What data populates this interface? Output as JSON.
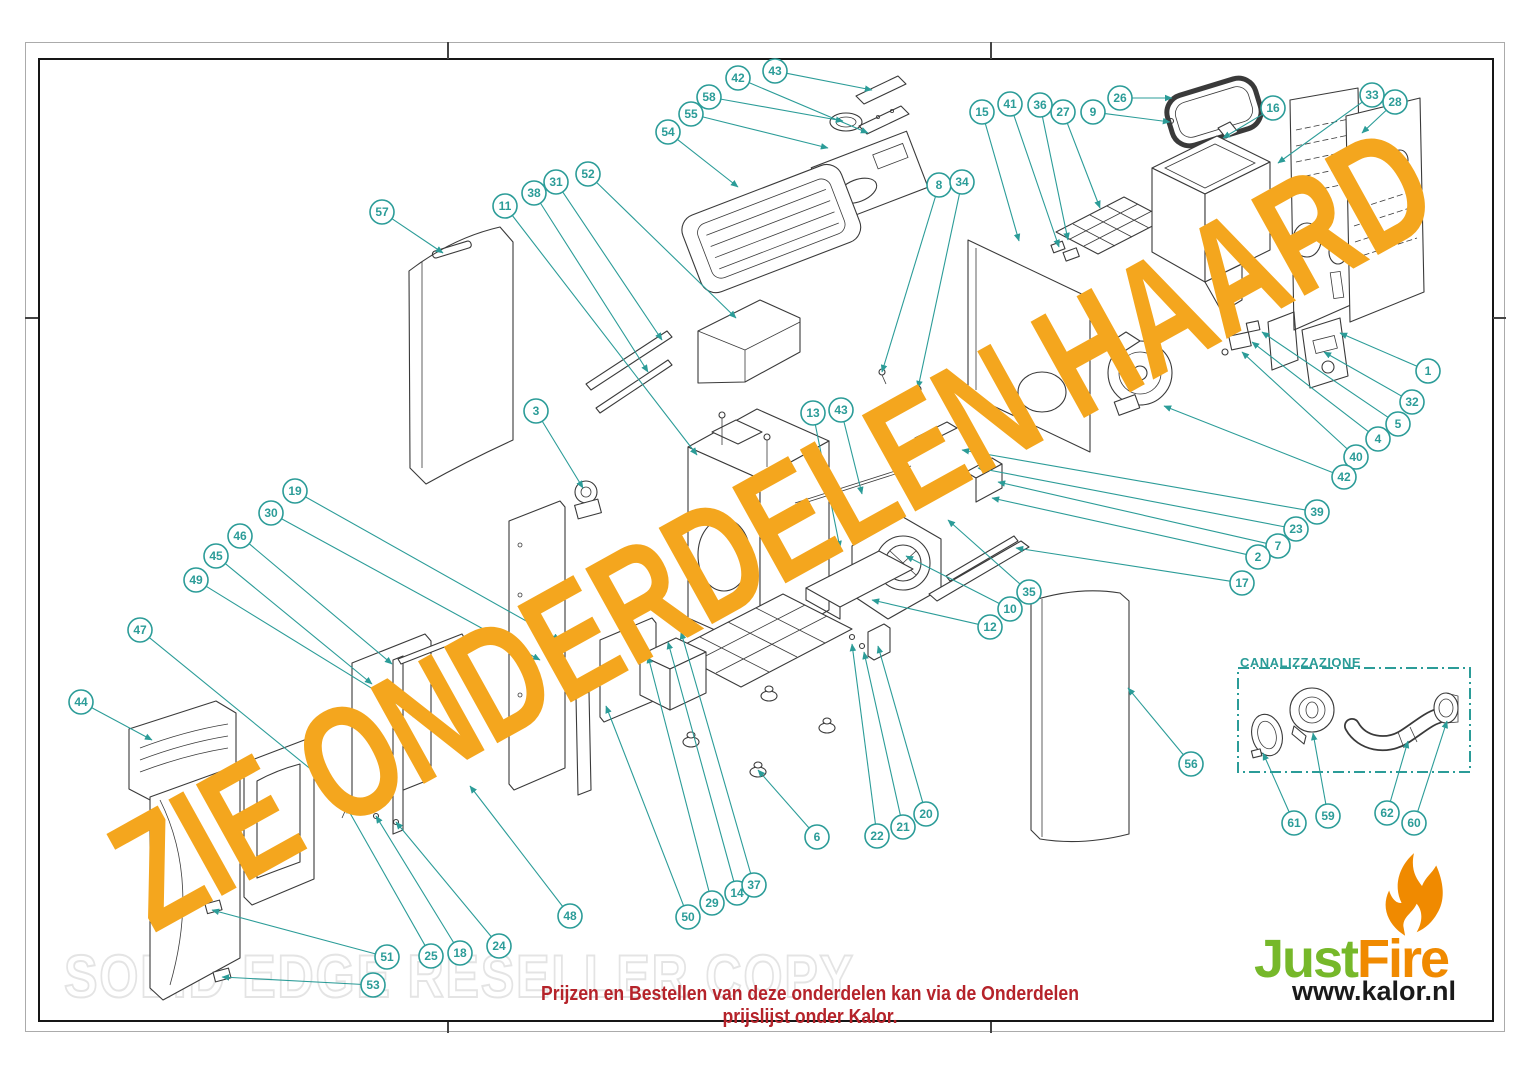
{
  "watermark": {
    "text": "ZIE ONDERDELEN HAARD",
    "color": "#F4A61E"
  },
  "copy_watermark": {
    "text": "SOLID EDGE RESELLER COPY"
  },
  "footer": {
    "order_note": "Prijzen en Bestellen van deze onderdelen kan via de Onderdelen prijslijst onder Kalor.",
    "color": "#B5232A"
  },
  "logo": {
    "brand_part1": "Just",
    "brand_part2": "Fire",
    "website": "www.kalor.nl",
    "green": "#76B82A",
    "orange": "#F08A00"
  },
  "inset_box": {
    "label": "CANALIZZAZIONE",
    "color": "#2B9C98"
  },
  "diagram": {
    "callout_color": "#2B9C98",
    "line_color": "#3a3a3a",
    "callouts": [
      {
        "n": "43",
        "x": 775,
        "y": 71,
        "tx": 872,
        "ty": 90
      },
      {
        "n": "42",
        "x": 738,
        "y": 78,
        "tx": 868,
        "ty": 133
      },
      {
        "n": "58",
        "x": 709,
        "y": 97,
        "tx": 843,
        "ty": 121
      },
      {
        "n": "55",
        "x": 691,
        "y": 114,
        "tx": 828,
        "ty": 148
      },
      {
        "n": "54",
        "x": 668,
        "y": 132,
        "tx": 738,
        "ty": 187
      },
      {
        "n": "26",
        "x": 1120,
        "y": 98,
        "tx": 1172,
        "ty": 98
      },
      {
        "n": "9",
        "x": 1093,
        "y": 112,
        "tx": 1170,
        "ty": 122
      },
      {
        "n": "27",
        "x": 1063,
        "y": 112,
        "tx": 1100,
        "ty": 208
      },
      {
        "n": "36",
        "x": 1040,
        "y": 105,
        "tx": 1068,
        "ty": 240
      },
      {
        "n": "41",
        "x": 1010,
        "y": 104,
        "tx": 1059,
        "ty": 247
      },
      {
        "n": "15",
        "x": 982,
        "y": 112,
        "tx": 1019,
        "ty": 241
      },
      {
        "n": "16",
        "x": 1273,
        "y": 108,
        "tx": 1223,
        "ty": 138
      },
      {
        "n": "33",
        "x": 1372,
        "y": 95,
        "tx": 1278,
        "ty": 163
      },
      {
        "n": "28",
        "x": 1395,
        "y": 102,
        "tx": 1362,
        "ty": 133
      },
      {
        "n": "8",
        "x": 939,
        "y": 185,
        "tx": 882,
        "ty": 372
      },
      {
        "n": "34",
        "x": 962,
        "y": 182,
        "tx": 918,
        "ty": 388
      },
      {
        "n": "57",
        "x": 382,
        "y": 212,
        "tx": 443,
        "ty": 253
      },
      {
        "n": "11",
        "x": 505,
        "y": 206,
        "tx": 697,
        "ty": 455
      },
      {
        "n": "38",
        "x": 534,
        "y": 193,
        "tx": 648,
        "ty": 372
      },
      {
        "n": "31",
        "x": 556,
        "y": 182,
        "tx": 662,
        "ty": 340
      },
      {
        "n": "52",
        "x": 588,
        "y": 174,
        "tx": 736,
        "ty": 318
      },
      {
        "n": "3",
        "x": 536,
        "y": 411,
        "tx": 583,
        "ty": 488
      },
      {
        "n": "13",
        "x": 813,
        "y": 413,
        "tx": 840,
        "ty": 548
      },
      {
        "n": "43",
        "x": 841,
        "y": 410,
        "tx": 862,
        "ty": 494
      },
      {
        "n": "1",
        "x": 1428,
        "y": 371,
        "tx": 1340,
        "ty": 333
      },
      {
        "n": "32",
        "x": 1412,
        "y": 402,
        "tx": 1324,
        "ty": 352
      },
      {
        "n": "5",
        "x": 1398,
        "y": 424,
        "tx": 1262,
        "ty": 332
      },
      {
        "n": "4",
        "x": 1378,
        "y": 439,
        "tx": 1252,
        "ty": 342
      },
      {
        "n": "40",
        "x": 1356,
        "y": 457,
        "tx": 1242,
        "ty": 352
      },
      {
        "n": "42",
        "x": 1344,
        "y": 477,
        "tx": 1164,
        "ty": 406
      },
      {
        "n": "39",
        "x": 1317,
        "y": 512,
        "tx": 962,
        "ty": 450
      },
      {
        "n": "23",
        "x": 1296,
        "y": 529,
        "tx": 978,
        "ty": 468
      },
      {
        "n": "7",
        "x": 1278,
        "y": 546,
        "tx": 998,
        "ty": 482
      },
      {
        "n": "2",
        "x": 1258,
        "y": 557,
        "tx": 992,
        "ty": 498
      },
      {
        "n": "17",
        "x": 1242,
        "y": 583,
        "tx": 1016,
        "ty": 548
      },
      {
        "n": "35",
        "x": 1029,
        "y": 592,
        "tx": 948,
        "ty": 520
      },
      {
        "n": "10",
        "x": 1010,
        "y": 609,
        "tx": 906,
        "ty": 556
      },
      {
        "n": "12",
        "x": 990,
        "y": 627,
        "tx": 872,
        "ty": 600
      },
      {
        "n": "19",
        "x": 295,
        "y": 491,
        "tx": 560,
        "ty": 640
      },
      {
        "n": "30",
        "x": 271,
        "y": 513,
        "tx": 540,
        "ty": 660
      },
      {
        "n": "46",
        "x": 240,
        "y": 536,
        "tx": 392,
        "ty": 664
      },
      {
        "n": "45",
        "x": 216,
        "y": 556,
        "tx": 372,
        "ty": 684
      },
      {
        "n": "49",
        "x": 196,
        "y": 580,
        "tx": 420,
        "ty": 718
      },
      {
        "n": "47",
        "x": 140,
        "y": 630,
        "tx": 340,
        "ty": 793
      },
      {
        "n": "44",
        "x": 81,
        "y": 702,
        "tx": 152,
        "ty": 740
      },
      {
        "n": "56",
        "x": 1191,
        "y": 764,
        "tx": 1128,
        "ty": 688
      },
      {
        "n": "6",
        "x": 817,
        "y": 837,
        "tx": 758,
        "ty": 770
      },
      {
        "n": "22",
        "x": 877,
        "y": 836,
        "tx": 852,
        "ty": 644
      },
      {
        "n": "21",
        "x": 903,
        "y": 827,
        "tx": 864,
        "ty": 652
      },
      {
        "n": "20",
        "x": 926,
        "y": 814,
        "tx": 878,
        "ty": 646
      },
      {
        "n": "48",
        "x": 570,
        "y": 916,
        "tx": 470,
        "ty": 786
      },
      {
        "n": "50",
        "x": 688,
        "y": 917,
        "tx": 606,
        "ty": 706
      },
      {
        "n": "29",
        "x": 712,
        "y": 903,
        "tx": 648,
        "ty": 656
      },
      {
        "n": "14",
        "x": 737,
        "y": 893,
        "tx": 668,
        "ty": 642
      },
      {
        "n": "37",
        "x": 754,
        "y": 885,
        "tx": 681,
        "ty": 632
      },
      {
        "n": "51",
        "x": 387,
        "y": 957,
        "tx": 212,
        "ty": 910
      },
      {
        "n": "25",
        "x": 431,
        "y": 956,
        "tx": 346,
        "ty": 806
      },
      {
        "n": "18",
        "x": 460,
        "y": 953,
        "tx": 376,
        "ty": 816
      },
      {
        "n": "24",
        "x": 499,
        "y": 946,
        "tx": 396,
        "ty": 822
      },
      {
        "n": "53",
        "x": 373,
        "y": 985,
        "tx": 222,
        "ty": 977
      },
      {
        "n": "61",
        "x": 1294,
        "y": 823,
        "tx": 1263,
        "ty": 753
      },
      {
        "n": "59",
        "x": 1328,
        "y": 816,
        "tx": 1313,
        "ty": 733
      },
      {
        "n": "62",
        "x": 1387,
        "y": 813,
        "tx": 1408,
        "ty": 741
      },
      {
        "n": "60",
        "x": 1414,
        "y": 823,
        "tx": 1447,
        "ty": 721
      }
    ]
  }
}
